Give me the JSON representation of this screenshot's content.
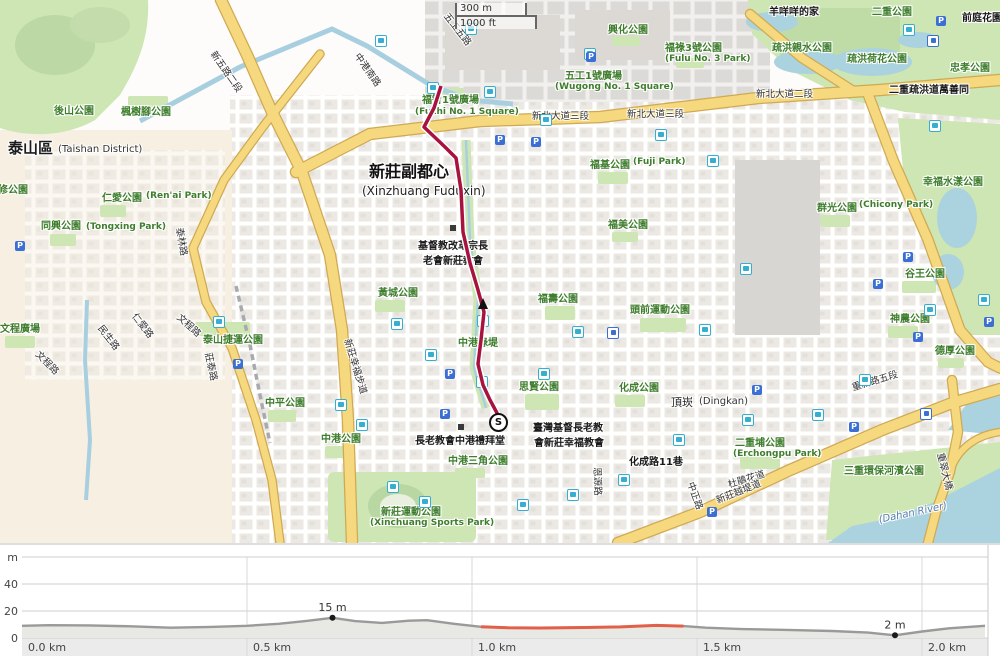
{
  "map": {
    "scale_bar": {
      "metric": "300 m",
      "imperial": "1000 ft"
    },
    "route": {
      "start_marker": "S",
      "color": "#a8123e",
      "points": [
        [
          441,
          86
        ],
        [
          434,
          108
        ],
        [
          424,
          127
        ],
        [
          445,
          147
        ],
        [
          456,
          158
        ],
        [
          461,
          190
        ],
        [
          463,
          232
        ],
        [
          470,
          263
        ],
        [
          478,
          290
        ],
        [
          484,
          312
        ],
        [
          481,
          340
        ],
        [
          478,
          364
        ],
        [
          483,
          385
        ],
        [
          490,
          400
        ],
        [
          497,
          413
        ],
        [
          497,
          418
        ]
      ]
    },
    "labels": [
      [
        "後山公園",
        54,
        107,
        "park",
        0
      ],
      [
        "楓樹腳公園",
        121,
        108,
        "park",
        0
      ],
      [
        "修公園",
        -2,
        186,
        "park",
        0
      ],
      [
        "泰山區",
        8,
        141,
        "place",
        0
      ],
      [
        "(Taishan District)",
        58,
        145,
        "place-en",
        0
      ],
      [
        "仁愛公園",
        102,
        194,
        "park",
        0
      ],
      [
        "(Ren'ai Park)",
        146,
        192,
        "park-en",
        0
      ],
      [
        "同興公園",
        41,
        222,
        "park",
        0
      ],
      [
        "(Tongxing Park)",
        86,
        223,
        "park-en",
        0
      ],
      [
        "泰山捷運公園",
        203,
        336,
        "park",
        0
      ],
      [
        "文程廣場",
        0,
        325,
        "park",
        0
      ],
      [
        "中平公園",
        265,
        399,
        "park",
        0
      ],
      [
        "中港公園",
        321,
        435,
        "park",
        0
      ],
      [
        "黃城公園",
        378,
        289,
        "park",
        0
      ],
      [
        "新莊運動公園",
        381,
        508,
        "park",
        0
      ],
      [
        "(Xinchuang Sports Park)",
        370,
        519,
        "park-en",
        0
      ],
      [
        "中港三角公園",
        448,
        457,
        "park",
        0
      ],
      [
        "中港綠堤",
        458,
        339,
        "park",
        0
      ],
      [
        "福壽公園",
        538,
        295,
        "park",
        0
      ],
      [
        "思賢公園",
        519,
        383,
        "park",
        0
      ],
      [
        "福基公園",
        590,
        161,
        "park",
        0
      ],
      [
        "(Fuji Park)",
        633,
        158,
        "park-en",
        0
      ],
      [
        "福美公園",
        608,
        221,
        "park",
        0
      ],
      [
        "福智1號廣場",
        422,
        96,
        "park",
        0
      ],
      [
        "(Fuzhi No. 1 Square)",
        415,
        108,
        "park-en",
        0
      ],
      [
        "五工1號廣場",
        565,
        72,
        "park",
        0
      ],
      [
        "(Wugong No. 1 Square)",
        555,
        83,
        "park-en",
        0
      ],
      [
        "興化公園",
        608,
        26,
        "park",
        0
      ],
      [
        "福祿3號公園",
        665,
        44,
        "park",
        0
      ],
      [
        "(Fulu No. 3 Park)",
        665,
        55,
        "park-en",
        0
      ],
      [
        "疏洪親水公園",
        772,
        44,
        "park",
        0
      ],
      [
        "疏洪荷花公園",
        847,
        55,
        "park",
        0
      ],
      [
        "二重公園",
        872,
        8,
        "park",
        0
      ],
      [
        "忠孝公園",
        950,
        64,
        "park",
        0
      ],
      [
        "幸福水漾公園",
        923,
        178,
        "park",
        0
      ],
      [
        "群光公園",
        817,
        204,
        "park",
        0
      ],
      [
        "(Chicony Park)",
        859,
        201,
        "park-en",
        0
      ],
      [
        "谷王公園",
        905,
        270,
        "park",
        0
      ],
      [
        "神農公園",
        890,
        315,
        "park",
        0
      ],
      [
        "德厚公園",
        935,
        347,
        "park",
        0
      ],
      [
        "頭前運動公園",
        630,
        306,
        "park",
        0
      ],
      [
        "化成公園",
        619,
        384,
        "park",
        0
      ],
      [
        "二重埔公園",
        735,
        439,
        "park",
        0
      ],
      [
        "(Erchongpu Park)",
        733,
        450,
        "park-en",
        0
      ],
      [
        "三重環保河濱公園",
        844,
        467,
        "park",
        0
      ],
      [
        "羊咩咩的家",
        769,
        8,
        "poi",
        0
      ],
      [
        "前庭花園",
        962,
        14,
        "poi",
        0
      ],
      [
        "二重疏洪道萬善同",
        889,
        86,
        "poi",
        0
      ],
      [
        "新莊副都心",
        369,
        164,
        "city",
        0
      ],
      [
        "(Xinzhuang Fuduxin)",
        362,
        185,
        "city-en",
        0
      ],
      [
        "基督教改革宗長",
        418,
        242,
        "poi",
        0
      ],
      [
        "老會新莊教會",
        423,
        257,
        "poi",
        0
      ],
      [
        "長老教會中港禮拜堂",
        415,
        437,
        "poi",
        0
      ],
      [
        "臺灣基督長老教",
        533,
        424,
        "poi",
        0
      ],
      [
        "會新莊幸福教會",
        534,
        439,
        "poi",
        0
      ],
      [
        "頂崁",
        671,
        397,
        "place-sm",
        0
      ],
      [
        "(Dingkan)",
        699,
        397,
        "place-en",
        0
      ],
      [
        "化成路11巷",
        629,
        458,
        "poi",
        0
      ],
      [
        "新北大道三段",
        532,
        112,
        "road",
        0
      ],
      [
        "新北大道三段",
        627,
        110,
        "road",
        0
      ],
      [
        "新北大道二段",
        756,
        90,
        "road",
        0
      ],
      [
        "重新路五段",
        851,
        384,
        "road",
        -17
      ],
      [
        "五工五路",
        449,
        12,
        "road",
        52
      ],
      [
        "新五路二段",
        216,
        50,
        "road",
        55
      ],
      [
        "中港南路",
        360,
        52,
        "road",
        55
      ],
      [
        "莊泰路",
        212,
        352,
        "road",
        78
      ],
      [
        "文程路",
        40,
        350,
        "road",
        45
      ],
      [
        "文程路",
        181,
        313,
        "road",
        42
      ],
      [
        "民生路",
        103,
        324,
        "road",
        52
      ],
      [
        "仁愛路",
        137,
        312,
        "road",
        52
      ],
      [
        "泰林路",
        183,
        227,
        "road",
        80
      ],
      [
        "中正路",
        694,
        481,
        "road",
        70
      ],
      [
        "恩源路",
        601,
        467,
        "road",
        88
      ],
      [
        "新莊幸福步道",
        351,
        338,
        "road",
        73
      ],
      [
        "杜鵑花道",
        727,
        481,
        "road",
        -17
      ],
      [
        "新莊越堤道",
        715,
        497,
        "road",
        -22
      ],
      [
        "重翠大橋",
        944,
        452,
        "road",
        76
      ],
      [
        "(Dahan River)",
        878,
        516,
        "water",
        -12
      ]
    ],
    "icons": {
      "bus": {
        "positions": [
          [
            380,
            40
          ],
          [
            470,
            28
          ],
          [
            432,
            87
          ],
          [
            489,
            91
          ],
          [
            545,
            119
          ],
          [
            589,
            53
          ],
          [
            660,
            134
          ],
          [
            712,
            160
          ],
          [
            745,
            268
          ],
          [
            704,
            329
          ],
          [
            577,
            331
          ],
          [
            543,
            373
          ],
          [
            482,
            320
          ],
          [
            481,
            381
          ],
          [
            430,
            354
          ],
          [
            396,
            323
          ],
          [
            218,
            321
          ],
          [
            340,
            404
          ],
          [
            361,
            424
          ],
          [
            392,
            486
          ],
          [
            424,
            501
          ],
          [
            522,
            504
          ],
          [
            572,
            494
          ],
          [
            623,
            479
          ],
          [
            678,
            439
          ],
          [
            747,
            419
          ],
          [
            817,
            414
          ],
          [
            864,
            379
          ],
          [
            929,
            309
          ],
          [
            983,
            299
          ],
          [
            908,
            29
          ],
          [
            934,
            125
          ]
        ]
      },
      "parking": {
        "glyph": "P",
        "positions": [
          [
            500,
            140
          ],
          [
            536,
            142
          ],
          [
            591,
            57
          ],
          [
            941,
            21
          ],
          [
            450,
            374
          ],
          [
            445,
            414
          ],
          [
            238,
            364
          ],
          [
            908,
            257
          ],
          [
            878,
            284
          ],
          [
            918,
            337
          ],
          [
            989,
            322
          ],
          [
            757,
            390
          ],
          [
            712,
            512
          ],
          [
            854,
            427
          ],
          [
            20,
            246
          ]
        ]
      },
      "metro": {
        "positions": [
          [
            612,
            332
          ],
          [
            925,
            413
          ],
          [
            932,
            40
          ]
        ]
      },
      "building": {
        "positions": [
          [
            455,
            230
          ],
          [
            463,
            429
          ]
        ]
      }
    }
  },
  "chart_data": {
    "type": "area",
    "title": "Elevation profile",
    "ylabel": "m",
    "ylim": [
      0,
      60
    ],
    "xlim_km": [
      0,
      2.147
    ],
    "grid": true,
    "y_ticks": [
      {
        "label": "m",
        "value": 60
      },
      {
        "label": "40",
        "value": 40
      },
      {
        "label": "20",
        "value": 20
      },
      {
        "label": "0",
        "value": 0
      }
    ],
    "x_ticks": [
      {
        "label": "0.0 km",
        "km": 0
      },
      {
        "label": "0.5 km",
        "km": 0.5
      },
      {
        "label": "1.0 km",
        "km": 1.0
      },
      {
        "label": "1.5 km",
        "km": 1.5
      },
      {
        "label": "2.0 km",
        "km": 2.0
      }
    ],
    "profile": [
      [
        0,
        9
      ],
      [
        0.06,
        9.5
      ],
      [
        0.15,
        9.3
      ],
      [
        0.25,
        8.6
      ],
      [
        0.33,
        7.6
      ],
      [
        0.42,
        8.2
      ],
      [
        0.5,
        9.0
      ],
      [
        0.57,
        10.5
      ],
      [
        0.63,
        12.5
      ],
      [
        0.69,
        15
      ],
      [
        0.74,
        12.5
      ],
      [
        0.8,
        11.2
      ],
      [
        0.86,
        12.8
      ],
      [
        0.9,
        13.2
      ],
      [
        0.96,
        10.5
      ],
      [
        1.02,
        8.3
      ],
      [
        1.08,
        7.6
      ],
      [
        1.15,
        7.4
      ],
      [
        1.25,
        7.8
      ],
      [
        1.33,
        8.2
      ],
      [
        1.41,
        9.3
      ],
      [
        1.47,
        8.8
      ],
      [
        1.52,
        7.6
      ],
      [
        1.6,
        6.6
      ],
      [
        1.7,
        6.0
      ],
      [
        1.8,
        5.2
      ],
      [
        1.88,
        4.0
      ],
      [
        1.94,
        2
      ],
      [
        2.0,
        4.8
      ],
      [
        2.06,
        7.2
      ],
      [
        2.14,
        9.0
      ]
    ],
    "highlight_segment_km": [
      1.02,
      1.475
    ],
    "highlight_color": "#e2604a",
    "line_color": "#9a9a9a",
    "fill_color": "#e8e8e5",
    "annotations": [
      {
        "km": 0.69,
        "m": 15,
        "label": "15 m"
      },
      {
        "km": 1.94,
        "m": 2,
        "label": "2 m"
      }
    ]
  }
}
